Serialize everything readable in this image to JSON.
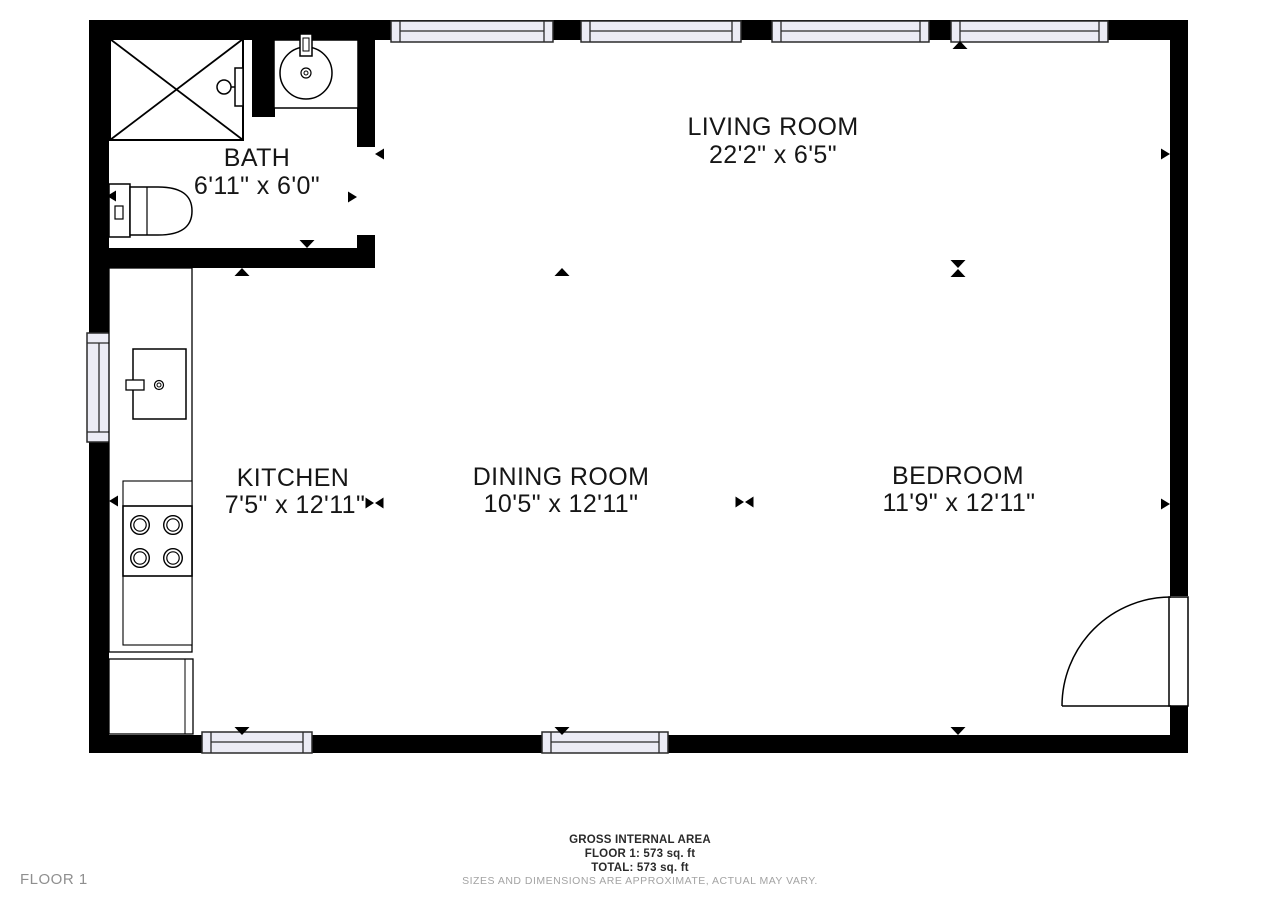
{
  "plan": {
    "rooms": {
      "bath": {
        "name": "BATH",
        "dims": "6'11\" x 6'0\""
      },
      "living": {
        "name": "LIVING ROOM",
        "dims": "22'2\" x 6'5\""
      },
      "kitchen": {
        "name": "KITCHEN",
        "dims": "7'5\" x 12'11\""
      },
      "dining": {
        "name": "DINING ROOM",
        "dims": "10'5\" x 12'11\""
      },
      "bedroom": {
        "name": "BEDROOM",
        "dims": "11'9\" x 12'11\""
      }
    },
    "fixtures": [
      "shower",
      "vanity-sink",
      "toilet",
      "kitchen-sink",
      "stove",
      "counter",
      "entry-door"
    ]
  },
  "footer": {
    "area_title": "GROSS INTERNAL AREA",
    "floor_line": "FLOOR 1: 573 sq. ft",
    "total_line": "TOTAL: 573 sq. ft",
    "disclaimer": "SIZES AND DIMENSIONS ARE APPROXIMATE, ACTUAL MAY VARY.",
    "floor_label": "FLOOR 1"
  },
  "colors": {
    "wall": "#000000",
    "background": "#ffffff",
    "window_glass": "#ECECF5",
    "label_text": "#161616",
    "muted_text": "#a3a3a3"
  },
  "icons": {
    "dimension_arrow": "filled-triangle",
    "dimension_bowtie": "two-triangles-tips-touching",
    "door_swing": "quarter-circle-arc"
  }
}
